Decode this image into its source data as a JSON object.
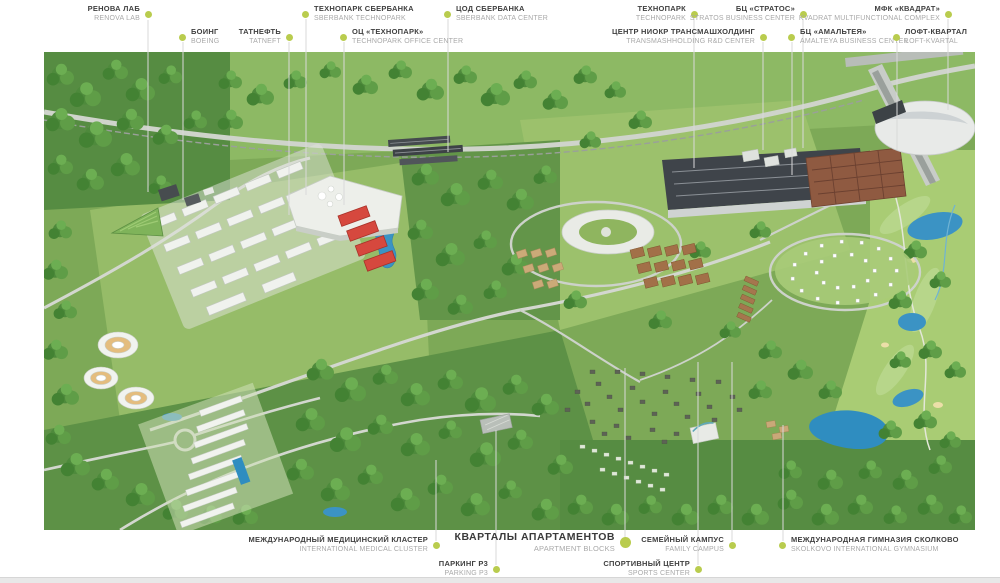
{
  "map": {
    "kind": "aerial-masterplan-render",
    "colors": {
      "label_dot": "#b9cc4e",
      "highlight_buildings": "#d6483e",
      "water": "#3b93c4",
      "terrain": "#7da957",
      "label_ru_text": "#404040",
      "label_en_text": "#a9a9a9"
    }
  },
  "labels": {
    "top": [
      {
        "id": "renova-lab",
        "ru": "РЕНОВА ЛАБ",
        "en": "RENOVA LAB",
        "dot": "right"
      },
      {
        "id": "sberbank-technopark",
        "ru": "ТЕХНОПАРК СБЕРБАНКА",
        "en": "SBERBANK TECHNOPARK",
        "dot": "left"
      },
      {
        "id": "sberbank-data-center",
        "ru": "ЦОД СБЕРБАНКА",
        "en": "SBERBANK DATA CENTER",
        "dot": "left"
      },
      {
        "id": "technopark",
        "ru": "ТЕХНОПАРК",
        "en": "TECHNOPARK",
        "dot": "right"
      },
      {
        "id": "stratos",
        "ru": "БЦ «СТРАТОС»",
        "en": "STRATOS BUSINESS CENTER",
        "dot": "right"
      },
      {
        "id": "kvadrat",
        "ru": "МФК «КВАДРАТ»",
        "en": "KVADRAT MULTIFUNCTIONAL COMPLEX",
        "dot": "right"
      },
      {
        "id": "boeing",
        "ru": "БОИНГ",
        "en": "BOEING",
        "dot": "left"
      },
      {
        "id": "tatneft",
        "ru": "ТАТНЕФТЬ",
        "en": "TATNEFT",
        "dot": "right"
      },
      {
        "id": "technopark-office-center",
        "ru": "ОЦ «ТЕХНОПАРК»",
        "en": "TECHNOPARK OFFICE CENTER",
        "dot": "left"
      },
      {
        "id": "transmashholding",
        "ru": "ЦЕНТР НИОКР ТРАНСМАШХОЛДИНГ",
        "en": "TRANSMASHHOLDING R&D CENTER",
        "dot": "right"
      },
      {
        "id": "amalteya",
        "ru": "БЦ «АМАЛЬТЕЯ»",
        "en": "AMALTEYA BUSINESS CENTER",
        "dot": "left"
      },
      {
        "id": "loft-kvartal",
        "ru": "ЛОФТ-КВАРТАЛ",
        "en": "LOFT-KVARTAL",
        "dot": "left"
      }
    ],
    "bottom": [
      {
        "id": "medical-cluster",
        "ru": "МЕЖДУНАРОДНЫЙ МЕДИЦИНСКИЙ КЛАСТЕР",
        "en": "INTERNATIONAL MEDICAL CLUSTER",
        "dot": "right"
      },
      {
        "id": "apartment-blocks",
        "ru": "КВАРТАЛЫ АПАРТАМЕНТОВ",
        "en": "APARTMENT BLOCKS",
        "dot": "right",
        "featured": true
      },
      {
        "id": "family-campus",
        "ru": "СЕМЕЙНЫЙ КАМПУС",
        "en": "FAMILY CAMPUS",
        "dot": "right"
      },
      {
        "id": "gymnasium",
        "ru": "МЕЖДУНАРОДНАЯ ГИМНАЗИЯ СКОЛКОВО",
        "en": "SKOLKOVO INTERNATIONAL GYMNASIUM",
        "dot": "left"
      },
      {
        "id": "parking-p3",
        "ru": "ПАРКИНГ Р3",
        "en": "PARKING P3",
        "dot": "right"
      },
      {
        "id": "sports-center",
        "ru": "СПОРТИВНЫЙ ЦЕНТР",
        "en": "SPORTS CENTER",
        "dot": "right"
      }
    ]
  }
}
